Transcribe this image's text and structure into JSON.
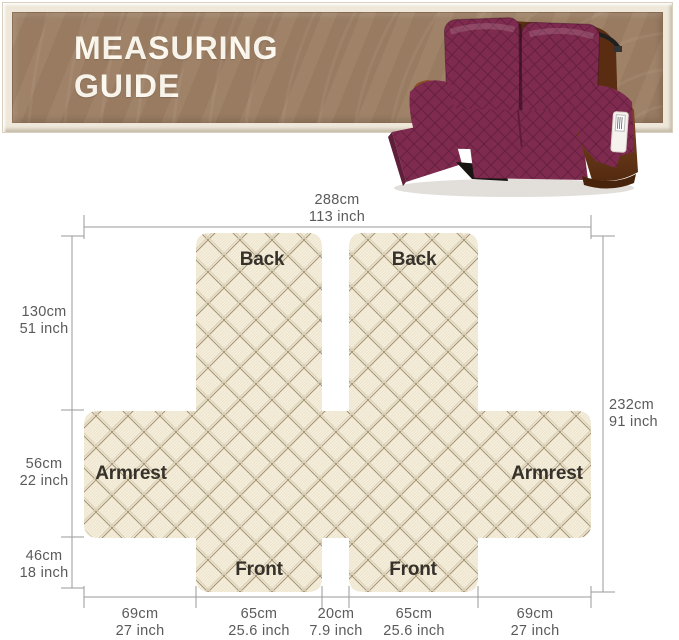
{
  "banner": {
    "title_line1": "MEASURING",
    "title_line2": "GUIDE"
  },
  "product_image": {
    "name": "recliner-loveseat-with-burgundy-quilted-cover"
  },
  "diagram": {
    "top_width": {
      "cm": "288cm",
      "inch": "113 inch"
    },
    "left_heights": [
      {
        "cm": "130cm",
        "inch": "51 inch"
      },
      {
        "cm": "56cm",
        "inch": "22 inch"
      },
      {
        "cm": "46cm",
        "inch": "18 inch"
      }
    ],
    "right_height": {
      "cm": "232cm",
      "inch": "91 inch"
    },
    "bottom_widths": [
      {
        "cm": "69cm",
        "inch": "27 inch"
      },
      {
        "cm": "65cm",
        "inch": "25.6 inch"
      },
      {
        "cm": "20cm",
        "inch": "7.9 inch"
      },
      {
        "cm": "65cm",
        "inch": "25.6 inch"
      },
      {
        "cm": "69cm",
        "inch": "27 inch"
      }
    ],
    "labels": {
      "back_left": "Back",
      "back_right": "Back",
      "armrest_left": "Armrest",
      "armrest_right": "Armrest",
      "front_left": "Front",
      "front_right": "Front"
    }
  },
  "colors": {
    "banner_brown": "#9c7e63",
    "banner_frame": "#efe8da",
    "title_text": "#fdf9ef",
    "cover_cream": "#f4eedb",
    "lattice_line": "#a69577",
    "cover_burgundy": "#7f2b4f",
    "leather_brown": "#6b3a1b",
    "measure_line": "#9a9a9a",
    "measure_text": "#5a5a5a",
    "piece_text": "#36312a"
  }
}
